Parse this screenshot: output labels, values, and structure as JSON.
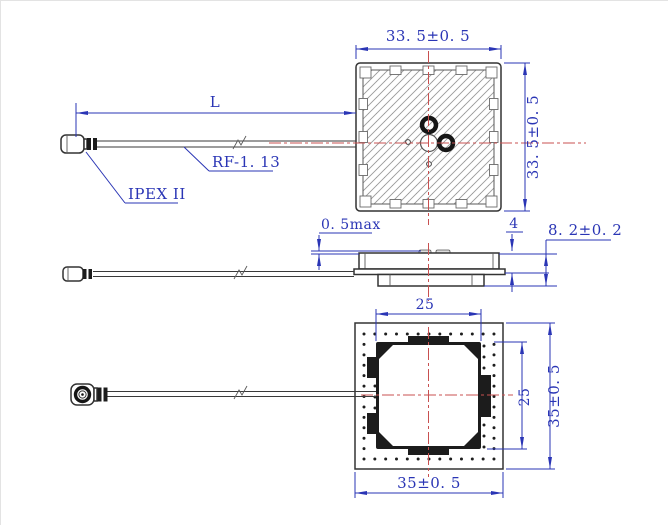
{
  "drawing": {
    "dimensions": {
      "top_view_width": "33. 5±0. 5",
      "top_view_height": "33. 5±0. 5",
      "cable_length": "L",
      "cable_type": "RF-1. 13",
      "connector_type": "IPEX II",
      "patch_protrusion_max": "0. 5max",
      "ceramic_thickness": "4",
      "overall_height": "8. 2±0. 2",
      "inner_square_width": "25",
      "inner_square_height": "25",
      "base_width": "35±0. 5",
      "base_height": "35±0. 5"
    },
    "colors": {
      "dimension_blue": "#2a35b5",
      "centerline_red": "#c85050",
      "outline_dark": "#3a3a3a",
      "fill_black": "#1c1c1c",
      "background": "#ffffff"
    }
  }
}
